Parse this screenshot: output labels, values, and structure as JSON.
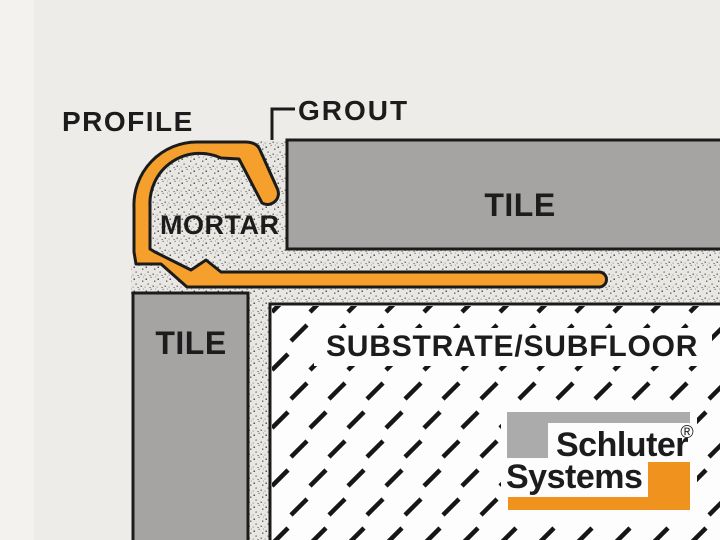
{
  "labels": {
    "profile": "PROFILE",
    "grout": "GROUT",
    "mortar": "MORTAR",
    "tile_top": "TILE",
    "tile_side": "TILE",
    "substrate": "SUBSTRATE/SUBFLOOR"
  },
  "logo": {
    "word1": "Schluter",
    "word2": "Systems",
    "registered_mark": "®"
  },
  "colors": {
    "background": "#EDECE9",
    "edge_light": "#F3F2EF",
    "profile_orange": "#F5A02C",
    "logo_orange": "#F0921E",
    "tile_gray": "#A5A4A2",
    "logo_gray": "#ABABAB",
    "outline_black": "#1B1B1B",
    "substrate_white": "#FDFDFD",
    "mortar_bg": "#E9E7E4",
    "text_black": "#1C1C1C"
  }
}
